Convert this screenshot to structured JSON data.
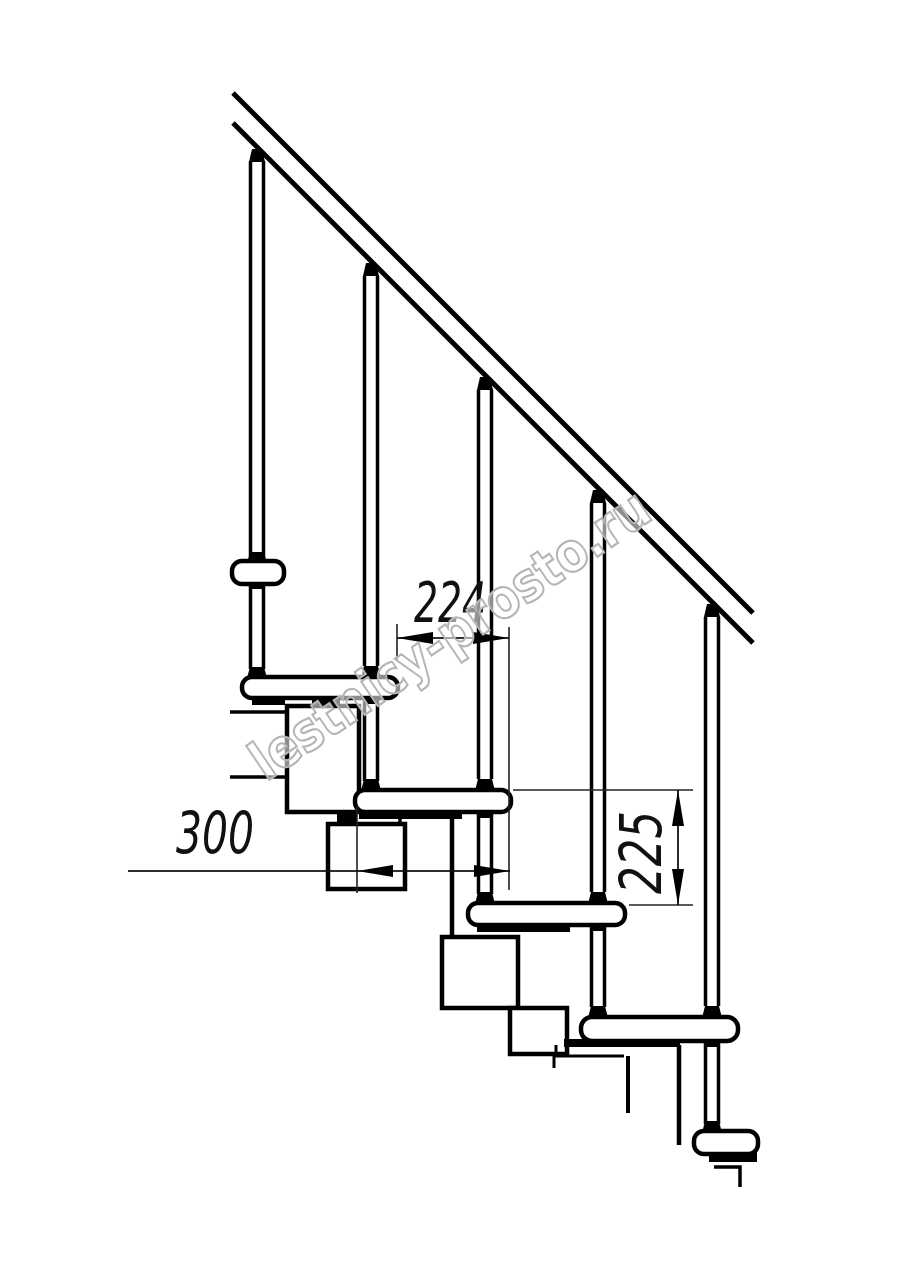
{
  "drawing": {
    "type": "technical-drawing",
    "subject": "modular staircase side elevation",
    "line_color": "#000000",
    "background_color": "#ffffff",
    "watermark_color": "#b5b5b5"
  },
  "dimensions": {
    "step_run": {
      "value": "224",
      "unit": "mm",
      "meaning": "horizontal step pitch between tread noses"
    },
    "tread_depth": {
      "value": "300",
      "unit": "mm",
      "meaning": "tread board depth"
    },
    "riser_height": {
      "value": "225",
      "unit": "mm",
      "meaning": "vertical rise between treads"
    }
  },
  "watermark": {
    "text": "lestnicy-prosto.ru"
  }
}
